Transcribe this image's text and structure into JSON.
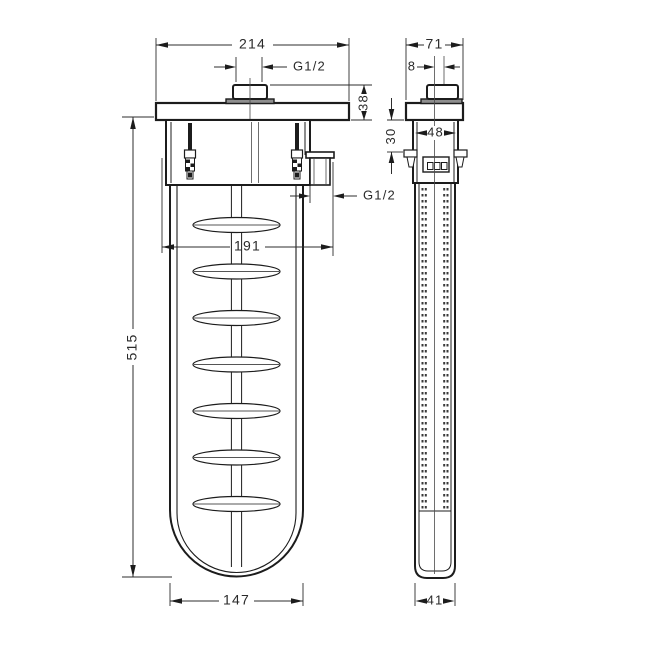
{
  "drawing": {
    "type": "technical-dimension-diagram",
    "background": "#ffffff",
    "line_color": "#1c1c1c",
    "dim_color": "#2d2d2d",
    "gray_fill": "#8e8e8e",
    "front_view": {
      "name": "front-view-bath-filler-waste-set",
      "slot_count": 7,
      "dims": {
        "overall_width": "214",
        "top_thread": "G1/2",
        "deck_button_height": "38",
        "outlet_thread": "G1/2",
        "center_distance": "191",
        "overall_height": "515",
        "body_width": "147"
      }
    },
    "side_view": {
      "name": "side-view-bath-filler-waste-set",
      "dims": {
        "overall_depth": "71",
        "button_offset": "8",
        "mount_range": "30",
        "housing_depth": "48",
        "body_depth": "41"
      }
    }
  }
}
